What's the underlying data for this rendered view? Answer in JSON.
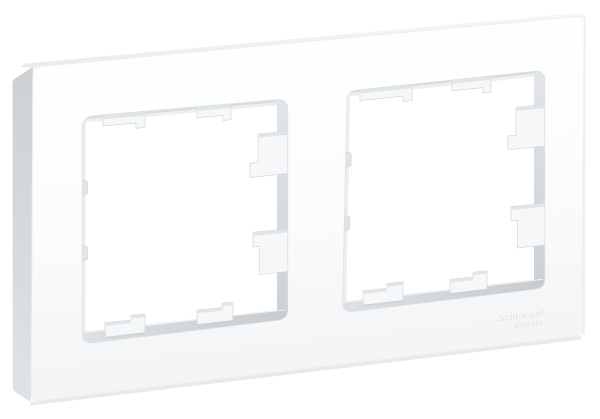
{
  "background_color": "#ffffff",
  "frame": {
    "window_count": 2,
    "material_look": "matte white plastic"
  },
  "logo": {
    "line1": "Schneider",
    "line2": "Electric"
  },
  "colors": {
    "frame_front_bright": "#ffffff",
    "frame_front_shade": "#f2f4f5",
    "frame_side_top": "#cdd1d4",
    "frame_side_bottom": "#e1e4e6",
    "frame_top_left": "#e9ecee",
    "frame_top_right": "#f6f7f8",
    "frame_bottom_face": "#e7e9eb",
    "inner_wall_light": "#e3e6e9",
    "inner_wall_dark": "#cbd0d4",
    "sill_light": "#dfe2e5",
    "sill_dark": "#c6cbcf",
    "tab_face": "#f5f7f8",
    "tab_top": "#e2e5e8",
    "tab_edge": "#cbd0d4",
    "emboss_shadow": "#d4d8db",
    "emboss_highlight": "#f7f8f9"
  }
}
